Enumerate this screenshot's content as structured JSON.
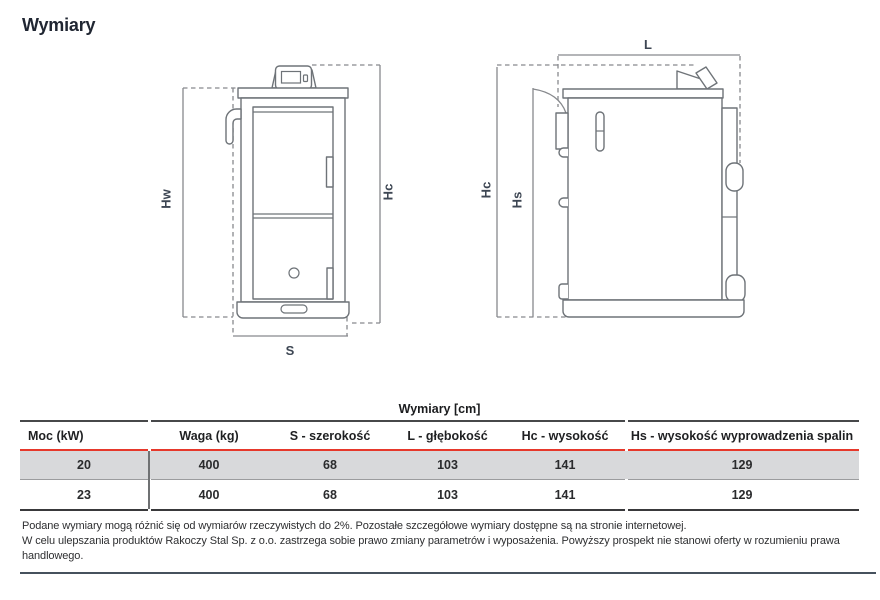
{
  "page": {
    "title": "Wymiary"
  },
  "drawings": {
    "front": {
      "label_hw": "Hw",
      "label_hc": "Hc",
      "label_s": "S"
    },
    "side": {
      "label_hc": "Hc",
      "label_hs": "Hs",
      "label_l": "L"
    }
  },
  "table": {
    "title": "Wymiary [cm]",
    "columns": [
      "Moc (kW)",
      "Waga (kg)",
      "S - szerokość",
      "L - głębokość",
      "Hc - wysokość",
      "Hs - wysokość wyprowadzenia spalin"
    ],
    "rows": [
      [
        "20",
        "400",
        "68",
        "103",
        "141",
        "129"
      ],
      [
        "23",
        "400",
        "68",
        "103",
        "141",
        "129"
      ]
    ]
  },
  "footnote": {
    "line1": "Podane wymiary mogą różnić się od wymiarów rzeczywistych do 2%. Pozostałe szczegółowe wymiary dostępne są na stronie internetowej.",
    "line2": "W celu ulepszania produktów Rakoczy Stal Sp. z o.o. zastrzega sobie prawo zmiany parametrów i wyposażenia. Powyższy prospekt nie stanowi oferty w rozumieniu prawa",
    "line3": "handlowego."
  },
  "colors": {
    "accent_red": "#e6382b",
    "row_highlight": "#d8d9db",
    "drawing_stroke": "#6e7378",
    "dimension_label": "#3d4653",
    "bottom_rule": "#46515d"
  }
}
